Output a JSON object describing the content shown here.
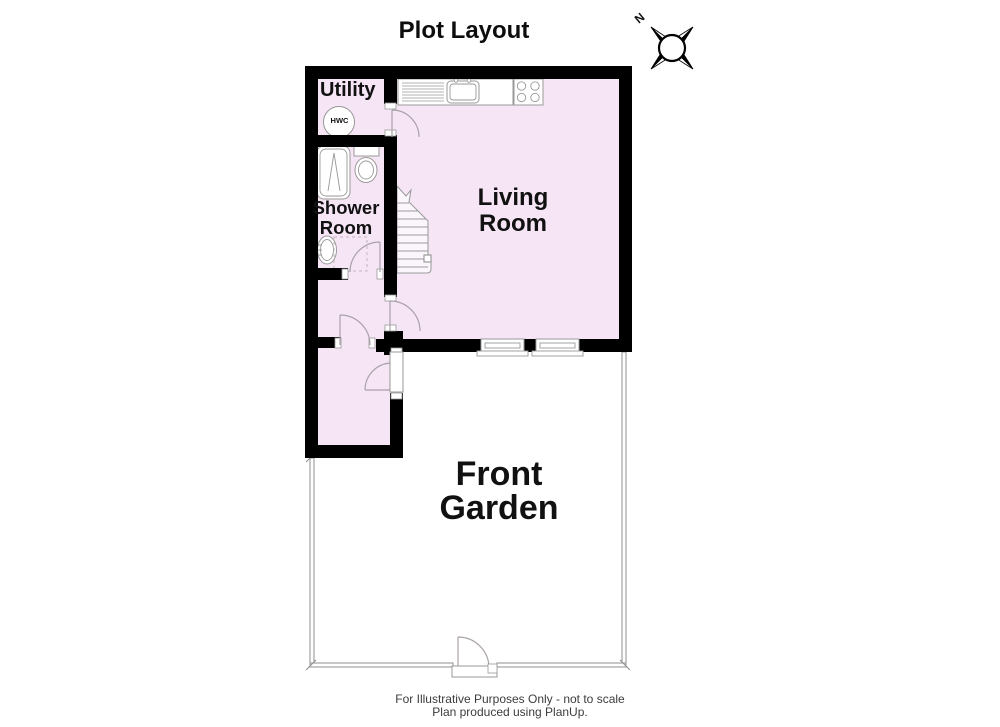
{
  "title": "Plot Layout",
  "compass": {
    "north": "N"
  },
  "rooms": {
    "utility": {
      "label": "Utility"
    },
    "hwc": {
      "label": "HWC"
    },
    "shower": {
      "label": "Shower Room"
    },
    "living": {
      "label": "Living Room"
    },
    "garden": {
      "label": "Front Garden"
    }
  },
  "footer": {
    "line1": "For Illustrative Purposes Only - not to scale",
    "line2": "Plan produced using PlanUp."
  },
  "colors": {
    "wall": "#000000",
    "room_fill": "#F6E5F5",
    "fixture_line": "#999999",
    "fence_line": "#8f8f8f"
  },
  "icons": [
    "compass-rose-icon",
    "hot-water-cylinder-icon",
    "bath-icon",
    "toilet-icon",
    "wash-basin-icon",
    "kitchen-sink-unit-icon",
    "hob-icon",
    "staircase-icon",
    "door-swing-icon",
    "window-icon",
    "garden-gate-icon"
  ]
}
